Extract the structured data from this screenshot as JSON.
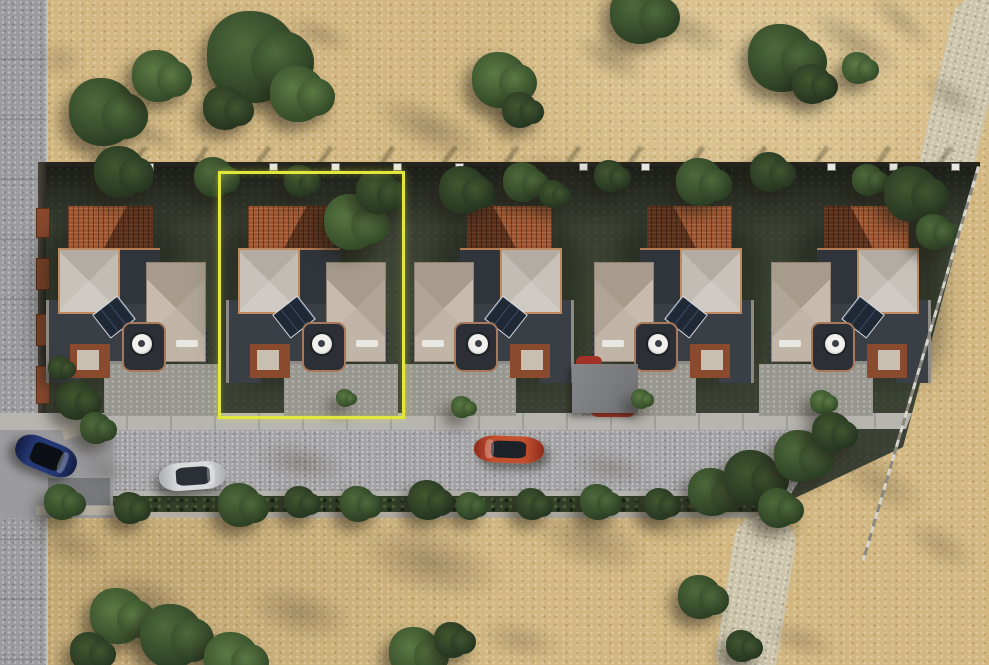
{
  "meta": {
    "title": "Aerial 3D render of a row of five houses with the second plot highlighted",
    "canvas_width": 989,
    "canvas_height": 665
  },
  "palette": {
    "sand": "#d2b781",
    "path": "#cdc5ab",
    "road": "#9b9b9e",
    "sidewalk": "#b7b5b0",
    "asphalt": "#a2a1a3",
    "plot": "#3b4134",
    "hedge": "#34402a",
    "walllight": "#b6b0a4",
    "tile": "#9c5530",
    "charcoal": "#3a3e45",
    "charcoal2": "#30343b",
    "drive": "#98978f",
    "highlight": "#e2e83b"
  },
  "scene": {
    "highlight": {
      "x": 218,
      "y": 171,
      "w": 181,
      "h": 242
    },
    "houses": [
      {
        "id": 1,
        "x": 38,
        "mirrored": false
      },
      {
        "id": 2,
        "x": 218,
        "mirrored": false
      },
      {
        "id": 3,
        "x": 400,
        "mirrored": true
      },
      {
        "id": 4,
        "x": 580,
        "mirrored": true
      },
      {
        "id": 5,
        "x": 757,
        "mirrored": true
      }
    ],
    "cars": [
      {
        "name": "car-blue",
        "x": 14,
        "y": 440,
        "w": 64,
        "h": 32,
        "rot": 22,
        "flip": false,
        "body": "#243875",
        "body2": "#141d42",
        "glass": "#0c1016"
      },
      {
        "name": "car-silver",
        "x": 159,
        "y": 462,
        "w": 67,
        "h": 28,
        "rot": -4,
        "flip": false,
        "body": "#d9dbdd",
        "body2": "#a9adb1",
        "glass": "#2b3036"
      },
      {
        "name": "car-red",
        "x": 474,
        "y": 436,
        "w": 70,
        "h": 27,
        "rot": 2,
        "flip": true,
        "body": "#c2502f",
        "body2": "#8e2c1d",
        "glass": "#1d2229"
      }
    ],
    "trees": [
      [
        103,
        112,
        34,
        1
      ],
      [
        158,
        76,
        26,
        2
      ],
      [
        253,
        57,
        46,
        1
      ],
      [
        298,
        94,
        28,
        2
      ],
      [
        225,
        108,
        22,
        3
      ],
      [
        500,
        80,
        28,
        2
      ],
      [
        520,
        110,
        18,
        3
      ],
      [
        640,
        14,
        30,
        1
      ],
      [
        782,
        58,
        34,
        1
      ],
      [
        812,
        84,
        20,
        3
      ],
      [
        858,
        68,
        16,
        2
      ],
      [
        120,
        172,
        26,
        3
      ],
      [
        214,
        177,
        20,
        1
      ],
      [
        300,
        181,
        16,
        3
      ],
      [
        352,
        222,
        28,
        2
      ],
      [
        378,
        192,
        22,
        3
      ],
      [
        463,
        190,
        24,
        3
      ],
      [
        523,
        182,
        20,
        1
      ],
      [
        553,
        194,
        14,
        3
      ],
      [
        610,
        176,
        16,
        3
      ],
      [
        700,
        182,
        24,
        1
      ],
      [
        770,
        172,
        20,
        3
      ],
      [
        868,
        180,
        16,
        1
      ],
      [
        912,
        194,
        28,
        3
      ],
      [
        934,
        232,
        18,
        1
      ],
      [
        76,
        400,
        20,
        3
      ],
      [
        96,
        428,
        16,
        1
      ],
      [
        60,
        368,
        12,
        3
      ],
      [
        462,
        407,
        11,
        2
      ],
      [
        345,
        398,
        9,
        2
      ],
      [
        641,
        399,
        10,
        2
      ],
      [
        822,
        402,
        12,
        2
      ],
      [
        62,
        502,
        18,
        1
      ],
      [
        130,
        508,
        16,
        3
      ],
      [
        240,
        505,
        22,
        1
      ],
      [
        300,
        502,
        16,
        3
      ],
      [
        358,
        504,
        18,
        1
      ],
      [
        428,
        500,
        20,
        3
      ],
      [
        470,
        506,
        14,
        1
      ],
      [
        532,
        504,
        16,
        3
      ],
      [
        598,
        502,
        18,
        1
      ],
      [
        660,
        504,
        16,
        3
      ],
      [
        712,
        492,
        24,
        1
      ],
      [
        752,
        478,
        28,
        3
      ],
      [
        800,
        456,
        26,
        1
      ],
      [
        832,
        432,
        20,
        3
      ],
      [
        778,
        508,
        20,
        1
      ],
      [
        118,
        616,
        28,
        2
      ],
      [
        172,
        636,
        32,
        1
      ],
      [
        232,
        660,
        28,
        2
      ],
      [
        90,
        652,
        20,
        3
      ],
      [
        415,
        653,
        26,
        2
      ],
      [
        452,
        640,
        18,
        3
      ],
      [
        700,
        597,
        22,
        1
      ],
      [
        742,
        646,
        16,
        3
      ]
    ],
    "shadows": [
      [
        430,
        128,
        170,
        70,
        24,
        0.5
      ],
      [
        560,
        178,
        130,
        60,
        20,
        0.45
      ],
      [
        610,
        58,
        110,
        50,
        28,
        0.45
      ],
      [
        688,
        30,
        130,
        55,
        24,
        0.4
      ],
      [
        855,
        42,
        150,
        55,
        32,
        0.45
      ],
      [
        950,
        95,
        100,
        45,
        32,
        0.4
      ],
      [
        320,
        34,
        100,
        45,
        20,
        0.4
      ],
      [
        150,
        135,
        90,
        40,
        24,
        0.4
      ],
      [
        60,
        60,
        70,
        60,
        0,
        0.3
      ],
      [
        900,
        20,
        120,
        40,
        40,
        0.35
      ],
      [
        430,
        562,
        210,
        95,
        14,
        0.5
      ],
      [
        590,
        540,
        170,
        85,
        18,
        0.45
      ],
      [
        300,
        612,
        150,
        75,
        14,
        0.45
      ],
      [
        145,
        600,
        140,
        75,
        18,
        0.5
      ],
      [
        665,
        520,
        130,
        65,
        14,
        0.4
      ],
      [
        878,
        482,
        150,
        70,
        30,
        0.4
      ],
      [
        940,
        545,
        110,
        55,
        30,
        0.35
      ],
      [
        800,
        640,
        110,
        50,
        16,
        0.35
      ],
      [
        520,
        640,
        120,
        55,
        12,
        0.35
      ],
      [
        300,
        462,
        130,
        55,
        10,
        0.4
      ],
      [
        610,
        468,
        120,
        50,
        12,
        0.35
      ],
      [
        180,
        500,
        90,
        40,
        8,
        0.35
      ],
      [
        105,
        470,
        80,
        50,
        10,
        0.3
      ],
      [
        70,
        545,
        110,
        60,
        16,
        0.4
      ]
    ],
    "fence_posts_x": [
      148,
      210,
      272,
      334,
      396,
      458,
      520,
      582,
      644,
      706,
      768,
      830,
      892,
      954
    ],
    "planters": [
      {
        "y": 208,
        "h": 28
      },
      {
        "y": 258,
        "h": 30
      },
      {
        "y": 314,
        "h": 30
      },
      {
        "y": 366,
        "h": 36
      }
    ]
  }
}
